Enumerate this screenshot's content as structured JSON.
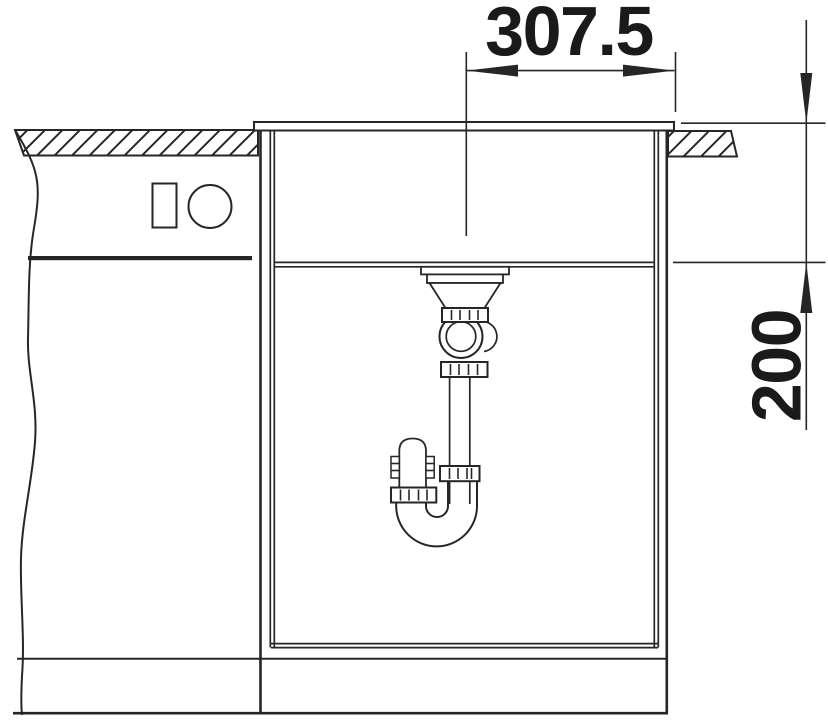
{
  "drawing": {
    "dimensions": {
      "horizontal": {
        "label": "307.5"
      },
      "vertical": {
        "label": "200"
      }
    }
  },
  "colors": {
    "line": "#262626",
    "text": "#1a1a1a",
    "background": "#ffffff"
  }
}
